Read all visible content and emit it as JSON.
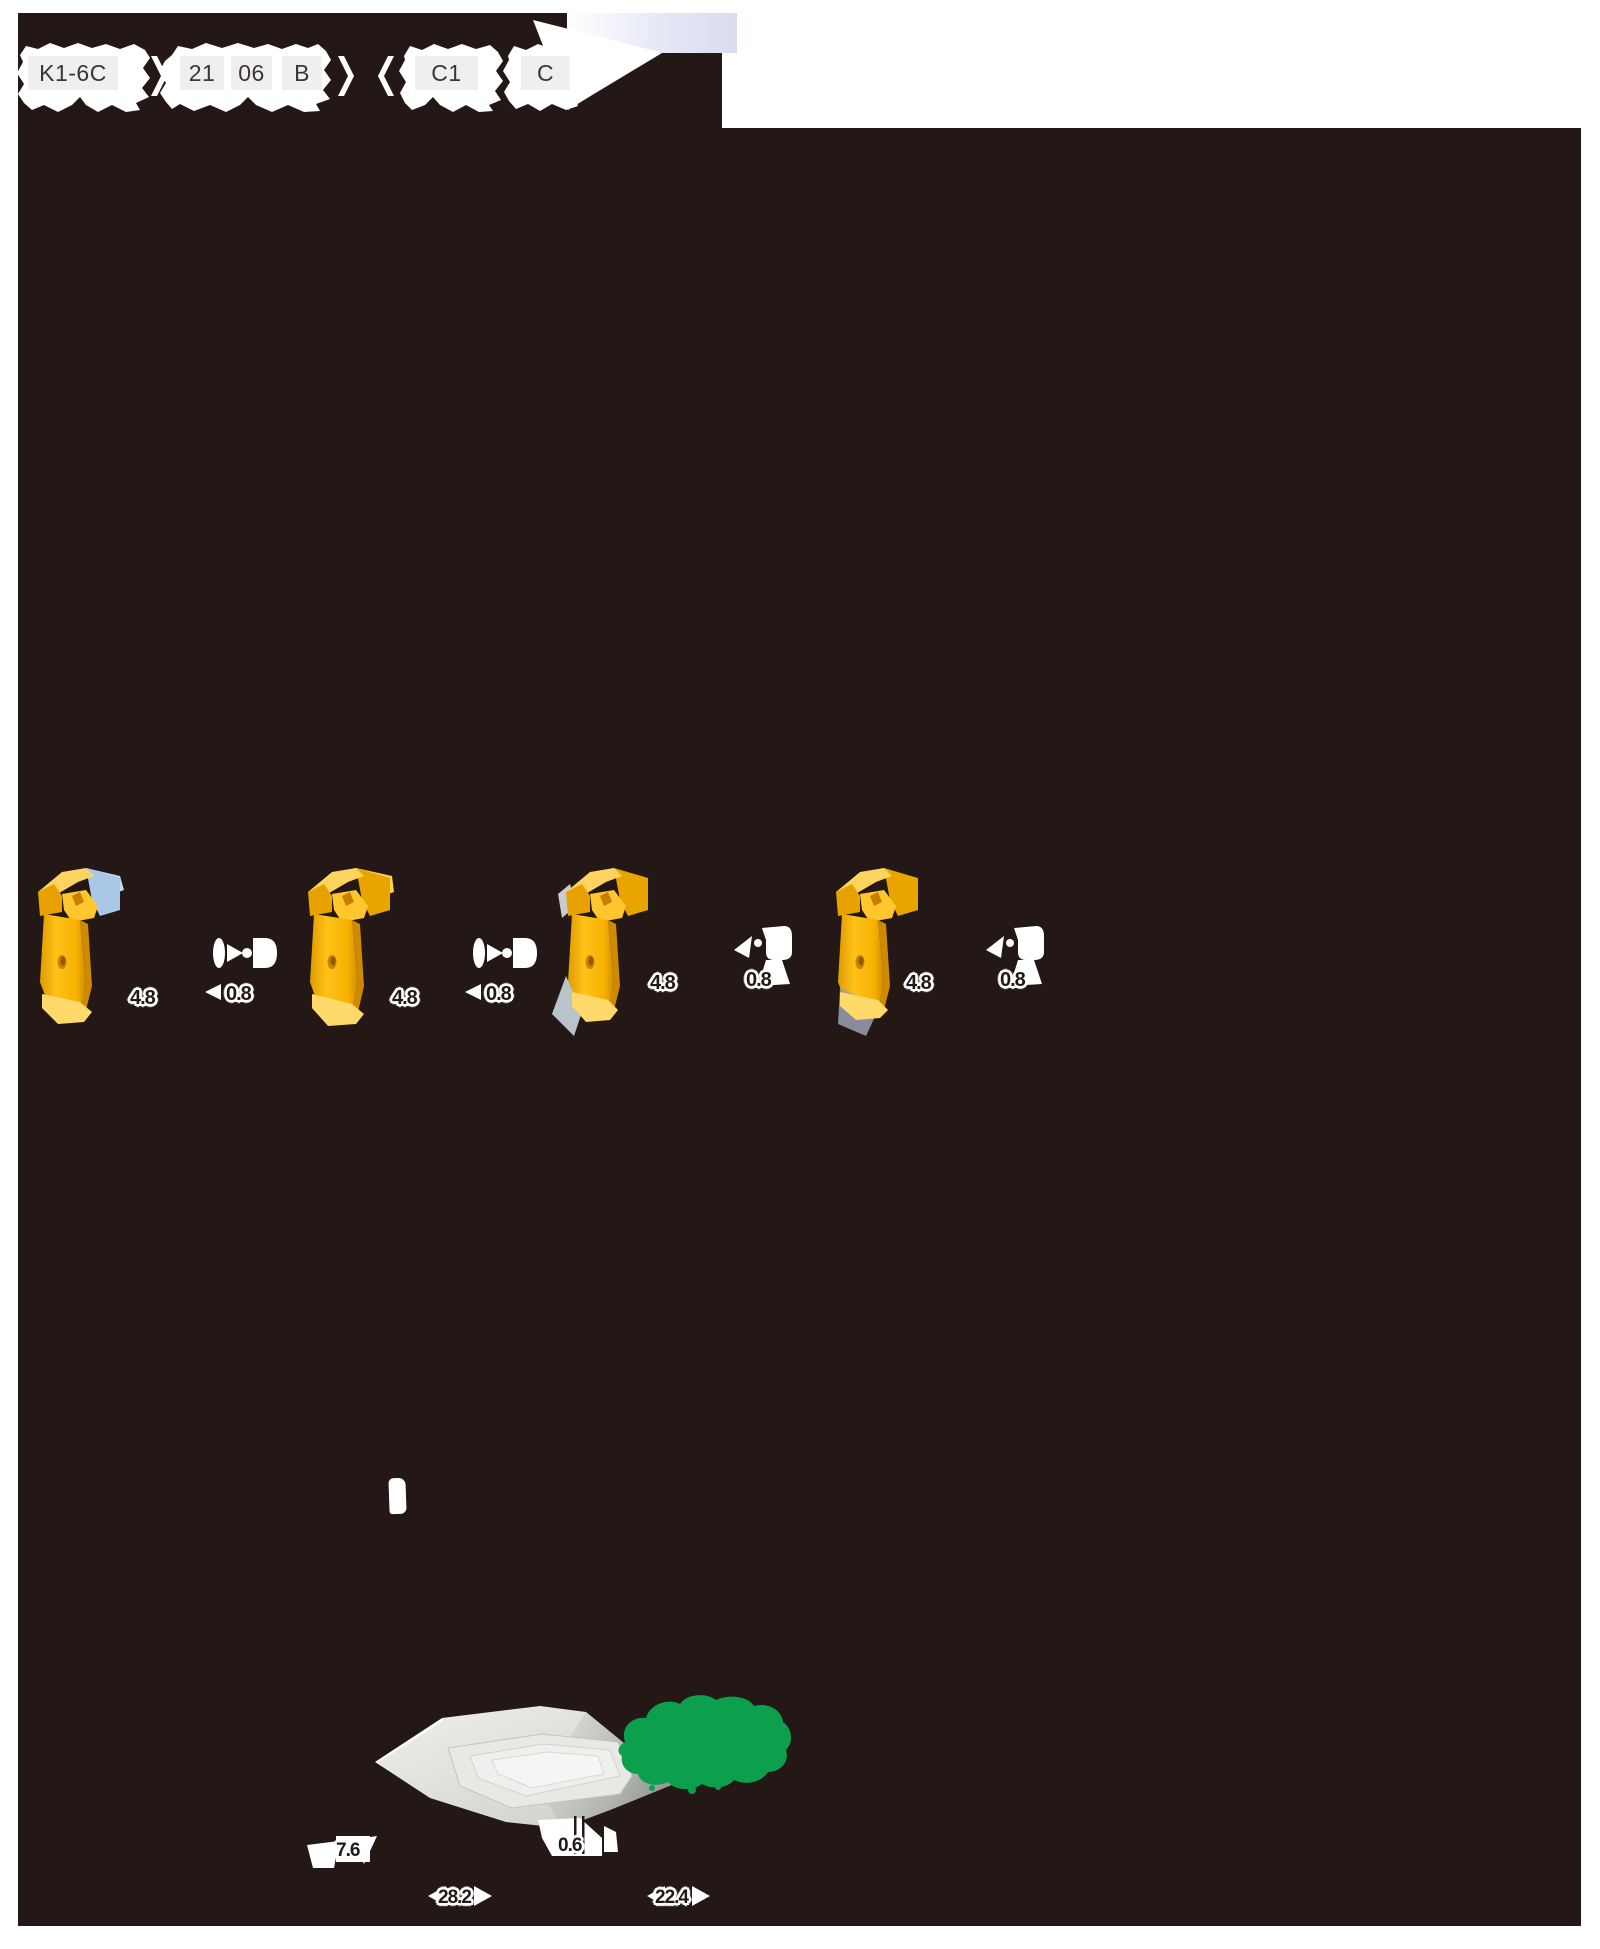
{
  "page": {
    "ink_color": "#231815",
    "paper_color": "#ffffff"
  },
  "order_code": {
    "boxes": [
      {
        "label": "K1-6C"
      },
      {
        "label": "21"
      },
      {
        "label": "06"
      },
      {
        "label": "B"
      },
      {
        "label": "C1"
      },
      {
        "label": "C"
      }
    ]
  },
  "insert_groups": [
    {
      "width": "4.8",
      "corner": "0.8"
    },
    {
      "width": "4.8",
      "corner": "0.8"
    },
    {
      "width": "4.8",
      "corner": "0.8"
    },
    {
      "width": "4.8",
      "corner": "0.8"
    }
  ],
  "bottom_view": {
    "dims": {
      "height": "7.6",
      "land": "0.6",
      "width_front": "28.2",
      "width_back": "22.4"
    }
  },
  "colors": {
    "insert_yellow": "#f6b000",
    "insert_yellow_light": "#ffd45e",
    "insert_yellow_dark": "#c98200",
    "highlight_blue": "#a9c8e8",
    "logo_green": "#0c9f4e",
    "header_lavender": "#d9dcf0",
    "gray_render": "#e7e9e5"
  }
}
